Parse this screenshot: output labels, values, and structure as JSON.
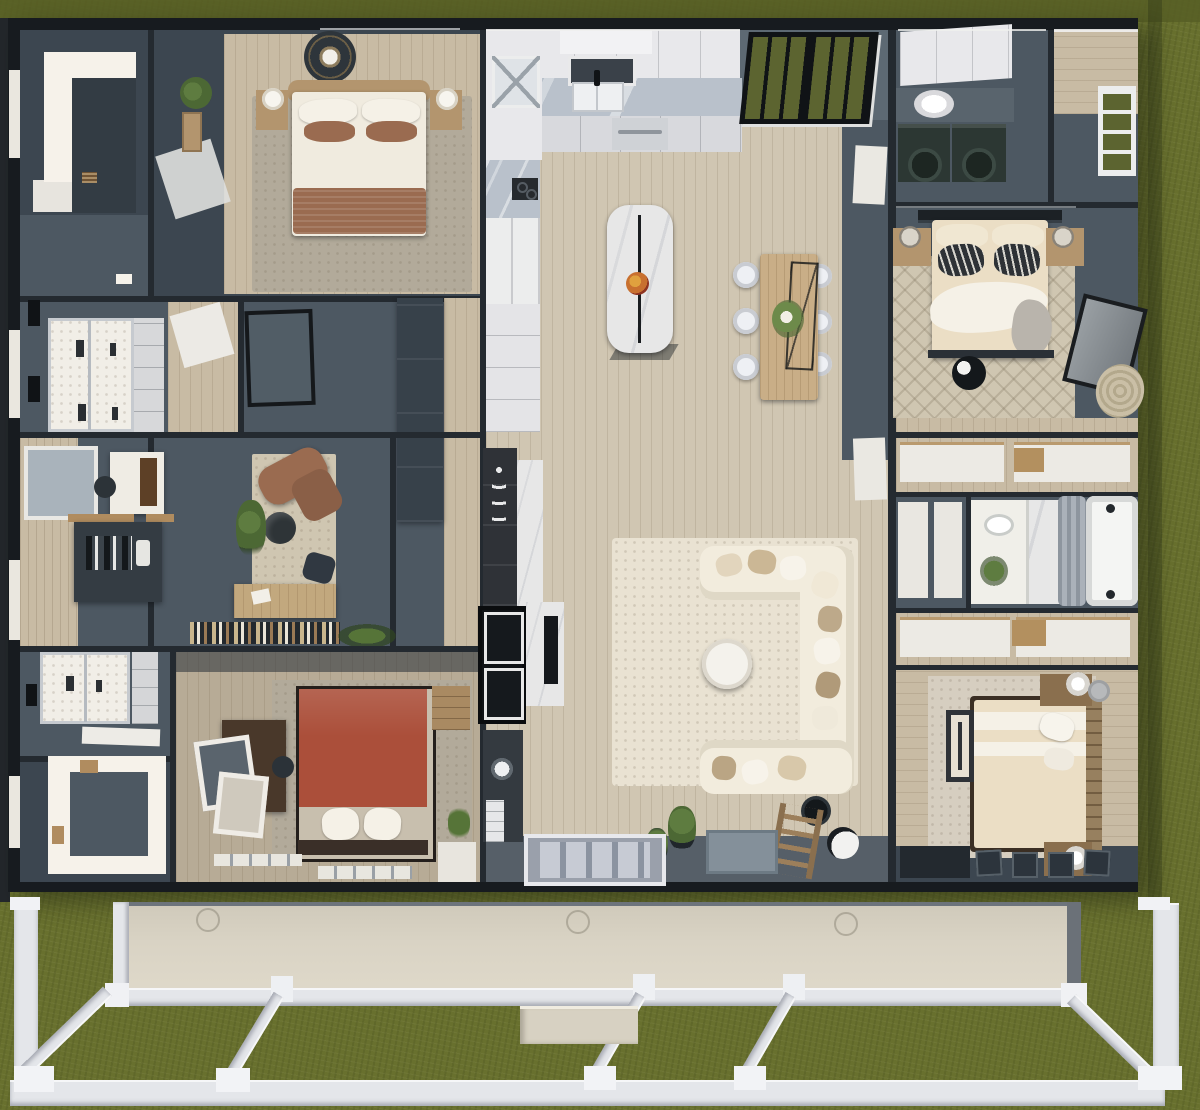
{
  "scene": {
    "title": "Top-down 3D render of a single-story modular home floor plan",
    "environment": {
      "ground": "grass lawn surrounding house",
      "foundation": "white porch framing with beige skirt wall below house"
    },
    "palette": {
      "grass": "#68702e",
      "grass_dark": "#575e25",
      "wall": "#171b1f",
      "wall_mid": "#242a30",
      "slate": "#4d5862",
      "slate_dark": "#3c4650",
      "slate_deep": "#333c44",
      "slate_light": "#5d6973",
      "white_lit": "#f6f2ea",
      "cab": "#e8e8eb",
      "cab_shade": "#d8d9dd",
      "marble": "#b9c1cb",
      "marble_white": "#e7e7e7",
      "wood": "#d0c6b2",
      "wood_gray": "#b7ab96",
      "wood_warm": "#c8bba4",
      "rug_cream": "#e9e2d2",
      "rug_gray": "#b2aa9a",
      "rug_pattern": "#cfc6b1",
      "sofa": "#f2ecdd",
      "bed_cream": "#ebdec5",
      "pillow_white": "#f5f1e7",
      "brown": "#9a6b50",
      "terracotta": "#ab4f3a",
      "wood_furn": "#b3956e",
      "wood_dark": "#49382a",
      "machine": "#2c3733",
      "ink": "#101316",
      "glass": "#5c6430",
      "door_gray": "#bcc2cc",
      "beam": "#e4e6ea",
      "skirt": "#d9d3c4",
      "curtain": "#97a0a9",
      "green": "#4c6834",
      "orange": "#c8702f"
    }
  },
  "rooms": [
    {
      "id": "walk-in-closet-top-left",
      "furniture": [
        "lit floor",
        "dark interior",
        "slat vent"
      ]
    },
    {
      "id": "primary-bedroom",
      "furniture": [
        "bed with white duvet",
        "brown accent pillows",
        "brown throw",
        "two nightstands with lamps",
        "ceiling medallion fan",
        "wall shelf",
        "potted plant",
        "gray area rug",
        "open door"
      ]
    },
    {
      "id": "double-shower-bathroom",
      "furniture": [
        "walk-in double shower",
        "glass door hinges",
        "door handle",
        "linen cabinet",
        "hall door"
      ]
    },
    {
      "id": "hallway-wardrobes",
      "furniture": [
        "dark wardrobe cabinets",
        "leaning art board",
        "wood hall floor"
      ]
    },
    {
      "id": "den-office",
      "furniture": [
        "leather lounge chair",
        "round side table",
        "potted plant",
        "wood desk",
        "desk chair",
        "bookshelf row",
        "shelf plant",
        "area rug"
      ]
    },
    {
      "id": "mudroom-craft-nook",
      "furniture": [
        "white desk",
        "sewing machine",
        "task chair",
        "dark console with bottles",
        "window"
      ]
    },
    {
      "id": "second-bathroom",
      "furniture": [
        "walk-in shower",
        "linen cabinet",
        "open white door"
      ]
    },
    {
      "id": "lower-walk-in-closet",
      "furniture": [
        "lit floor",
        "small stool"
      ]
    },
    {
      "id": "guest-bedroom-terracotta",
      "furniture": [
        "canopy bed with terracotta cover",
        "white pillows",
        "dark headboard",
        "dark desk",
        "leaning art frames",
        "desk chair",
        "tan dresser",
        "gray rug",
        "window seat slats"
      ]
    },
    {
      "id": "kitchen",
      "furniture": [
        "white upper cabinets",
        "marble counter",
        "double sink with black faucet",
        "window",
        "oven",
        "cooktop",
        "fridge",
        "glass corner cabinet",
        "pantry cabinets",
        "marble island",
        "island pendant",
        "fruit bowl"
      ]
    },
    {
      "id": "dining-area",
      "furniture": [
        "wood dining table",
        "six white chairs",
        "wire chandelier",
        "flower centerpiece"
      ]
    },
    {
      "id": "patio-french-doors",
      "furniture": [
        "black frame",
        "glass panes"
      ]
    },
    {
      "id": "living-room",
      "furniture": [
        "cream U-sectional",
        "throw pillows",
        "round white coffee table",
        "cream area rug",
        "arc floor lamp with globe",
        "decorative ladder",
        "potted plants",
        "gray doormat",
        "front door with glass panels"
      ]
    },
    {
      "id": "media-coffee-wall",
      "furniture": [
        "black fireplace built-in",
        "marble surround",
        "wall TV",
        "appliance column",
        "coffee-bar marble",
        "white drawers",
        "round fan"
      ]
    },
    {
      "id": "laundry-room",
      "furniture": [
        "washer",
        "dryer",
        "laundry basket",
        "white upper cabinets",
        "counter"
      ]
    },
    {
      "id": "rear-entry-hall",
      "furniture": [
        "exterior glass door"
      ]
    },
    {
      "id": "bedroom-iron-bed",
      "furniture": [
        "iron headboard bed",
        "patterned shams",
        "white throw",
        "two nightstands with lamps",
        "foot rail",
        "round pouf",
        "leaning mirror",
        "round jute rug",
        "patterned area rug"
      ]
    },
    {
      "id": "hall-closets-upper",
      "furniture": [
        "sliding white doors",
        "wood bench"
      ]
    },
    {
      "id": "hall-bathroom",
      "furniture": [
        "vanity with sink and flowers",
        "gray shower curtain",
        "bathtub",
        "white hall doors",
        "marble floor"
      ]
    },
    {
      "id": "hall-closets-lower",
      "furniture": [
        "sliding white doors",
        "wood bench"
      ]
    },
    {
      "id": "bedroom-wood-bed",
      "furniture": [
        "wood headboard bed",
        "striped duvet",
        "white pillows",
        "foot bench",
        "two nightstands with drum lamps",
        "slat wall panels",
        "dark console",
        "cream rug"
      ]
    }
  ],
  "porch": {
    "elements": [
      "beige skirt wall",
      "vent rings",
      "skirt edge beam",
      "mid beam",
      "bottom beam",
      "left post",
      "right post",
      "top caps",
      "diagonal braces",
      "footing pads",
      "entry step",
      "lawn"
    ]
  }
}
